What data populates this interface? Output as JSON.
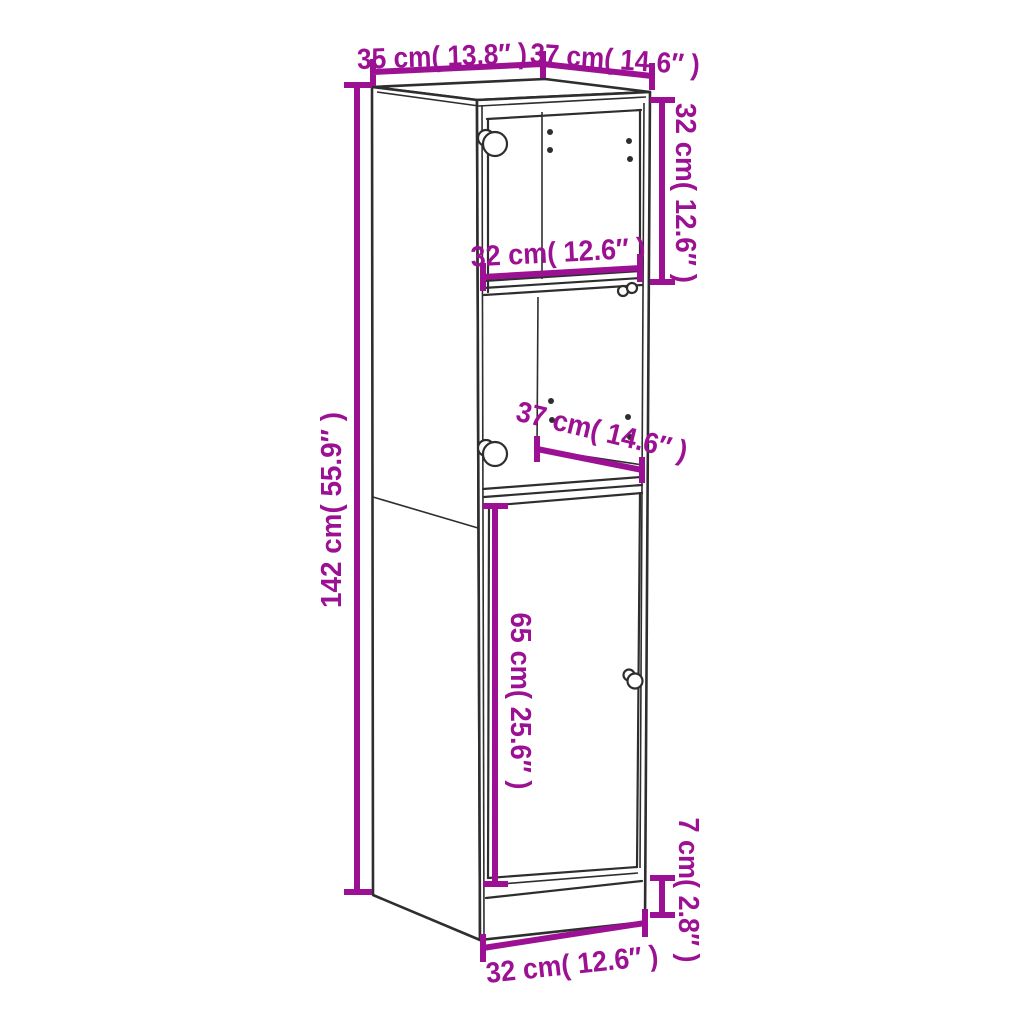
{
  "diagram": {
    "kind": "product-dimension-diagram",
    "subject": "highboard-cabinet-with-glass-doors",
    "colors": {
      "accent": "#9C1193",
      "line": "#2E2E2E",
      "background": "#FFFFFF"
    },
    "dimensions": {
      "top_width": {
        "label": "35 cm( 13.8″ )",
        "cm": 35,
        "inches": 13.8
      },
      "top_depth": {
        "label": "37 cm( 14.6″ )",
        "cm": 37,
        "inches": 14.6
      },
      "total_height": {
        "label": "142 cm( 55.9″ )",
        "cm": 142,
        "inches": 55.9
      },
      "upper_section_height": {
        "label": "32 cm( 12.6″ )",
        "cm": 32,
        "inches": 12.6
      },
      "inner_width": {
        "label": "32 cm( 12.6″ )",
        "cm": 32,
        "inches": 12.6
      },
      "shelf_depth": {
        "label": "37 cm( 14.6″ )",
        "cm": 37,
        "inches": 14.6
      },
      "door_height": {
        "label": "65 cm( 25.6″ )",
        "cm": 65,
        "inches": 25.6
      },
      "plinth_height": {
        "label": "7 cm( 2.8″ )",
        "cm": 7,
        "inches": 2.8
      },
      "bottom_width": {
        "label": "32 cm( 12.6″ )",
        "cm": 32,
        "inches": 12.6
      }
    }
  }
}
